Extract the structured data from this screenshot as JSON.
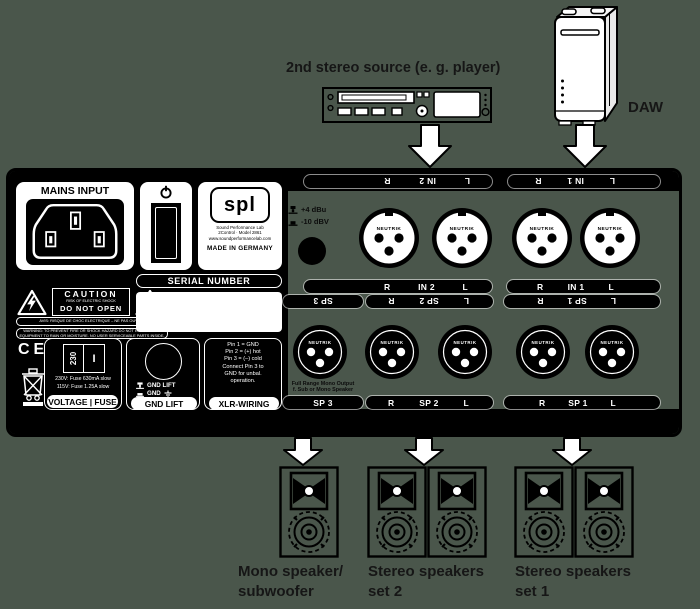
{
  "colors": {
    "background": "#4a564b",
    "panel": "#000000",
    "face": "#ffffff"
  },
  "sources": {
    "player_label": "2nd stereo source (e. g. player)",
    "daw_label": "DAW"
  },
  "panel": {
    "mains": {
      "title": "MAINS INPUT"
    },
    "brand": {
      "logo": "spl",
      "line1": "Sound Performance Lab",
      "line2": "2Control · Model 2861",
      "line3": "www.soundperformancelab.com",
      "made_in": "MADE IN GERMANY"
    },
    "serial_label": "SERIAL NUMBER",
    "caution": {
      "title": "CAUTION",
      "risk": "RISK OF ELECTRIC SHOCK",
      "do_not_open": "DO NOT OPEN",
      "avis": "AVIS: RISQUE DE CHOC ELECTRIQUE – NE PAS OUVRIR",
      "warning_line1": "WARNING: TO PREVENT FIRE OR SHOCK HAZARD DO NOT EXPOSE THIS",
      "warning_line2": "EQUIPMENT TO RAIN OR MOISTURE. NO USER SERVICEABLE PARTS INSIDE."
    },
    "ce_mark": "CE",
    "voltage": {
      "selector_value": "230",
      "selector_switch": "I",
      "fuse_line1": "230V: Fuse 630mA slow",
      "fuse_line2": "115V: Fuse 1.25A slow",
      "label": "VOLTAGE | FUSE"
    },
    "gnd": {
      "row1": "GND LIFT",
      "row2": "GND",
      "label": "GND LIFT"
    },
    "xlr_wiring": {
      "lines": [
        "Pin 1 = GND",
        "Pin 2 = (+) hot",
        "Pin 3 = (–) cold",
        "Connect Pin 3 to",
        "GND for unbal.",
        "operation."
      ],
      "label": "XLR-WIRING"
    },
    "level_switch": {
      "opt_out": "+4 dBu",
      "opt_in": "-10 dBV"
    },
    "neutrik": "NEUTRIK",
    "io": {
      "in1": {
        "name": "IN 1",
        "left": "R",
        "right": "L"
      },
      "in2": {
        "name": "IN 2",
        "left": "R",
        "right": "L"
      },
      "sp1": {
        "name": "SP 1",
        "left": "R",
        "right": "L"
      },
      "sp2": {
        "name": "SP 2",
        "left": "R",
        "right": "L"
      },
      "sp3": {
        "name": "SP 3",
        "note_line1": "Full Range Mono Output",
        "note_line2": "f. Sub or Mono Speaker"
      }
    }
  },
  "speakers": {
    "mono": {
      "line1": "Mono speaker/",
      "line2": "subwoofer"
    },
    "set2": {
      "line1": "Stereo speakers",
      "line2": "set 2"
    },
    "set1": {
      "line1": "Stereo speakers",
      "line2": "set 1"
    }
  }
}
